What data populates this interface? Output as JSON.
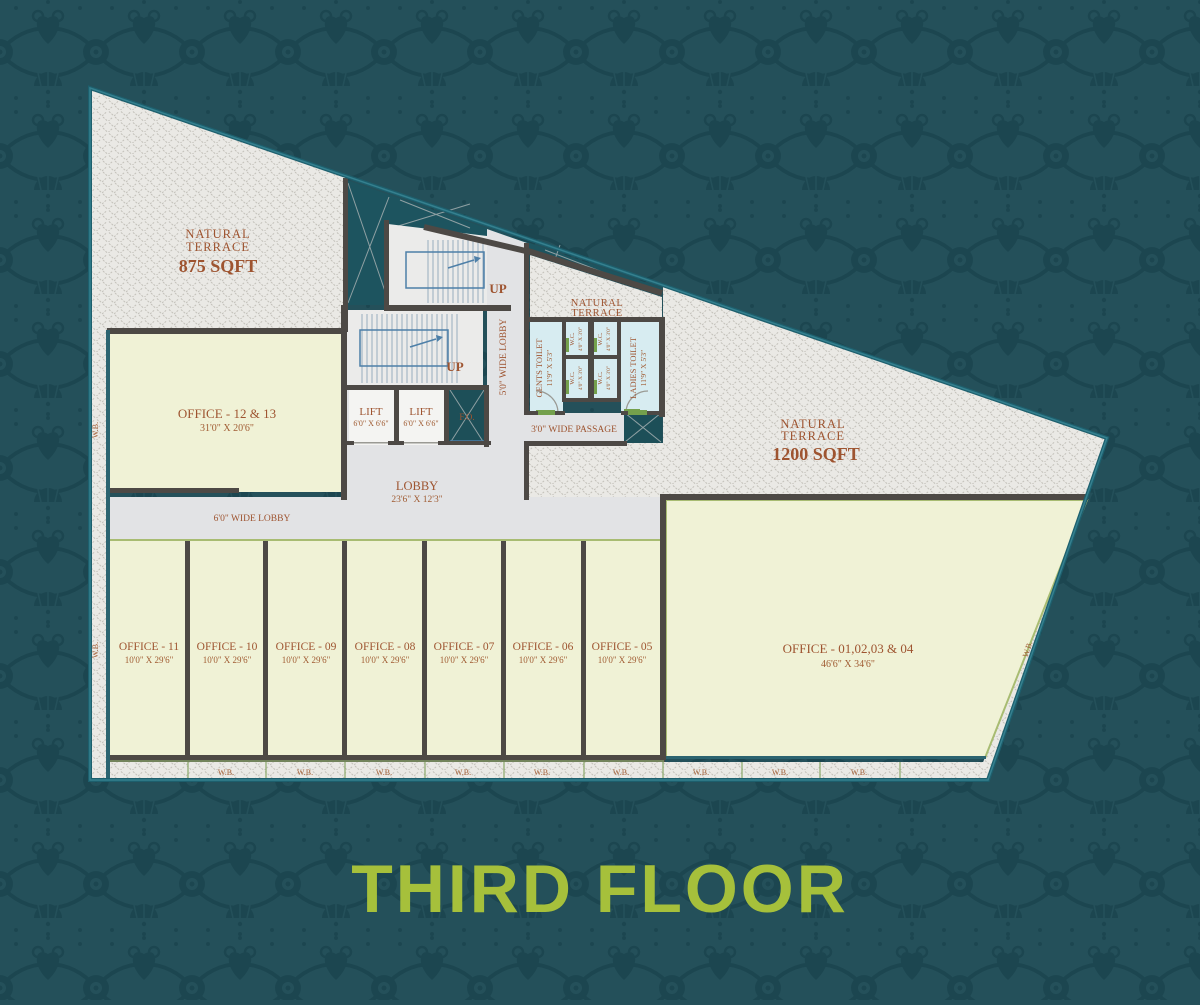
{
  "title": "THIRD FLOOR",
  "plan": {
    "terrace_top_left": {
      "line1": "NATURAL",
      "line2": "TERRACE",
      "area": "875 SQFT"
    },
    "terrace_right": {
      "line1": "NATURAL",
      "line2": "TERRACE",
      "area": "1200 SQFT"
    },
    "terrace_center": {
      "line1": "NATURAL",
      "line2": "TERRACE"
    },
    "stairs": {
      "up": "UP"
    },
    "lift": {
      "label": "LIFT",
      "dims": "6'0\" X 6'6\""
    },
    "duct": {
      "label": "F.O."
    },
    "lobby": {
      "label": "LOBBY",
      "dims": "23'6\" X 12'3\"",
      "wide6": "6'0\" WIDE LOBBY",
      "wide5": "5'0\" WIDE LOBBY",
      "passage": "3'0\" WIDE PASSAGE"
    },
    "toilets": {
      "gents": {
        "label": "GENTS TOILET",
        "dims": "11'9\" X 5'3\""
      },
      "ladies": {
        "label": "LADIES TOILET",
        "dims": "11'9\" X 5'3\""
      },
      "wc": {
        "label": "W.C.",
        "dims": "4'0\" X 3'0\""
      }
    },
    "office_12_13": {
      "label": "OFFICE - 12 & 13",
      "dims": "31'0\" X 20'6\""
    },
    "office_row": [
      {
        "label": "OFFICE - 11",
        "dims": "10'0\" X 29'6\""
      },
      {
        "label": "OFFICE - 10",
        "dims": "10'0\" X 29'6\""
      },
      {
        "label": "OFFICE - 09",
        "dims": "10'0\" X 29'6\""
      },
      {
        "label": "OFFICE - 08",
        "dims": "10'0\" X 29'6\""
      },
      {
        "label": "OFFICE - 07",
        "dims": "10'0\" X 29'6\""
      },
      {
        "label": "OFFICE - 06",
        "dims": "10'0\" X 29'6\""
      },
      {
        "label": "OFFICE - 05",
        "dims": "10'0\" X 29'6\""
      }
    ],
    "office_big": {
      "label": "OFFICE - 01,02,03 & 04",
      "dims": "46'6\" X 34'6\""
    },
    "wb": "W.B."
  },
  "colors": {
    "background": "#24505a",
    "pattern_motif": "#1c4650",
    "title_green": "#a6c03b",
    "label_rust": "#9e5430",
    "wall_dark": "#4d4945",
    "hatch_fill": "#eae9e5",
    "office_fill": "#f0f2d6",
    "lobby_fill": "#e2e3e5",
    "toilet_fill": "#d7ecf1",
    "teal_wall": "#2c6470"
  }
}
